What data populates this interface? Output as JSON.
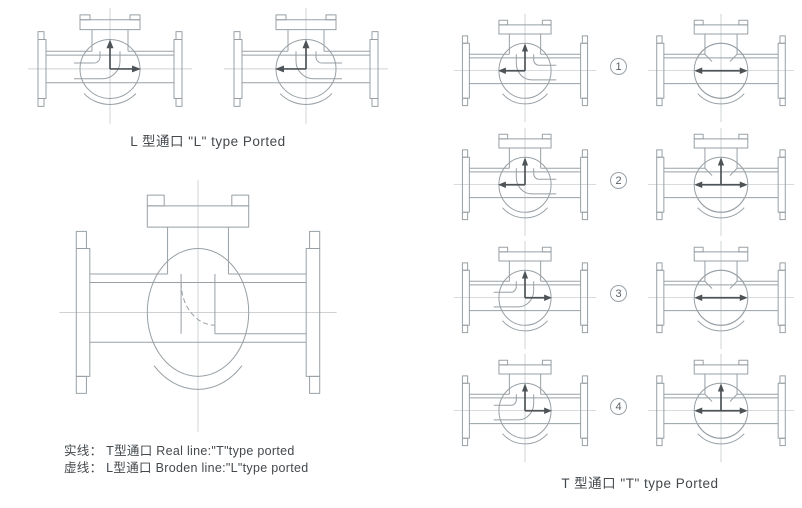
{
  "colors": {
    "line": "#98a0a5",
    "centerline": "#b0b7bb",
    "arrow": "#4d5357",
    "text": "#44494d",
    "background": "#ffffff"
  },
  "left_section": {
    "l_type": {
      "caption": "L 型通口 \"L\" type Ported",
      "valves": [
        {
          "name": "l-ported-valve-flow-up-right",
          "view": "side",
          "mirror": true,
          "arrows": [
            "up",
            "right"
          ]
        },
        {
          "name": "l-ported-valve-flow-up-left",
          "view": "side",
          "mirror": false,
          "arrows": [
            "up",
            "left"
          ]
        }
      ]
    },
    "t_section": {
      "legend_solid": "实线： T型通口 Real line:\"T\"type ported",
      "legend_broken": "虚线： L型通口 Broden line:\"L\"type ported",
      "valve": {
        "name": "t-ported-cross-section-valve",
        "view": "big",
        "arrows": []
      }
    }
  },
  "right_section": {
    "caption": "T 型通口 \"T\" type Ported",
    "rows": [
      {
        "number": "1",
        "left_valve": {
          "name": "t-row1-side-valve",
          "view": "side",
          "mirror": false,
          "arrows": [
            "up",
            "left"
          ]
        },
        "right_valve": {
          "name": "t-row1-front-valve",
          "view": "front",
          "domes": "both",
          "arrows": [
            "left-right"
          ]
        }
      },
      {
        "number": "2",
        "left_valve": {
          "name": "t-row2-side-valve",
          "view": "side",
          "mirror": false,
          "arrows": [
            "up",
            "left"
          ]
        },
        "right_valve": {
          "name": "t-row2-front-valve",
          "view": "front",
          "domes": "bottom",
          "arrows": [
            "up",
            "left-right"
          ]
        }
      },
      {
        "number": "3",
        "left_valve": {
          "name": "t-row3-side-valve",
          "view": "side",
          "mirror": true,
          "arrows": [
            "up",
            "right"
          ]
        },
        "right_valve": {
          "name": "t-row3-front-valve",
          "view": "front",
          "domes": "both",
          "arrows": [
            "left-right"
          ]
        }
      },
      {
        "number": "4",
        "left_valve": {
          "name": "t-row4-side-valve",
          "view": "side",
          "mirror": true,
          "arrows": [
            "up",
            "right"
          ]
        },
        "right_valve": {
          "name": "t-row4-front-valve",
          "view": "front",
          "domes": "bottom",
          "arrows": [
            "up",
            "left-right"
          ]
        }
      }
    ]
  }
}
